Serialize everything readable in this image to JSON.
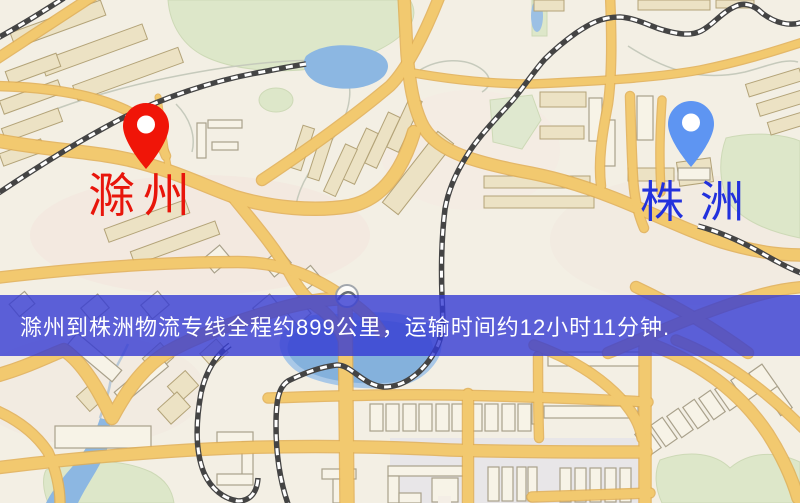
{
  "markers": {
    "origin": {
      "name": "滁州",
      "pin_color": "#f01508",
      "label_color": "#e8150b"
    },
    "destination": {
      "name": "株洲",
      "pin_color": "#5e95f2",
      "label_color": "#2231dd"
    }
  },
  "banner": {
    "text": "滁州到株洲物流专线全程约899公里，运输时间约12小时11分钟.",
    "background_color": "#353bd3",
    "text_color": "#ffffff",
    "distance_text": "约899公里",
    "duration_text": "约12小时11分钟"
  },
  "map_palette": {
    "background": "#f3efe4",
    "road_fill": "#f2c96f",
    "road_casing": "#e0ae54",
    "building": "#ece2c4",
    "building_outline": "#b3a378",
    "park": "#dde7c9",
    "water": "#8cb7e2",
    "railway": "#444444"
  }
}
